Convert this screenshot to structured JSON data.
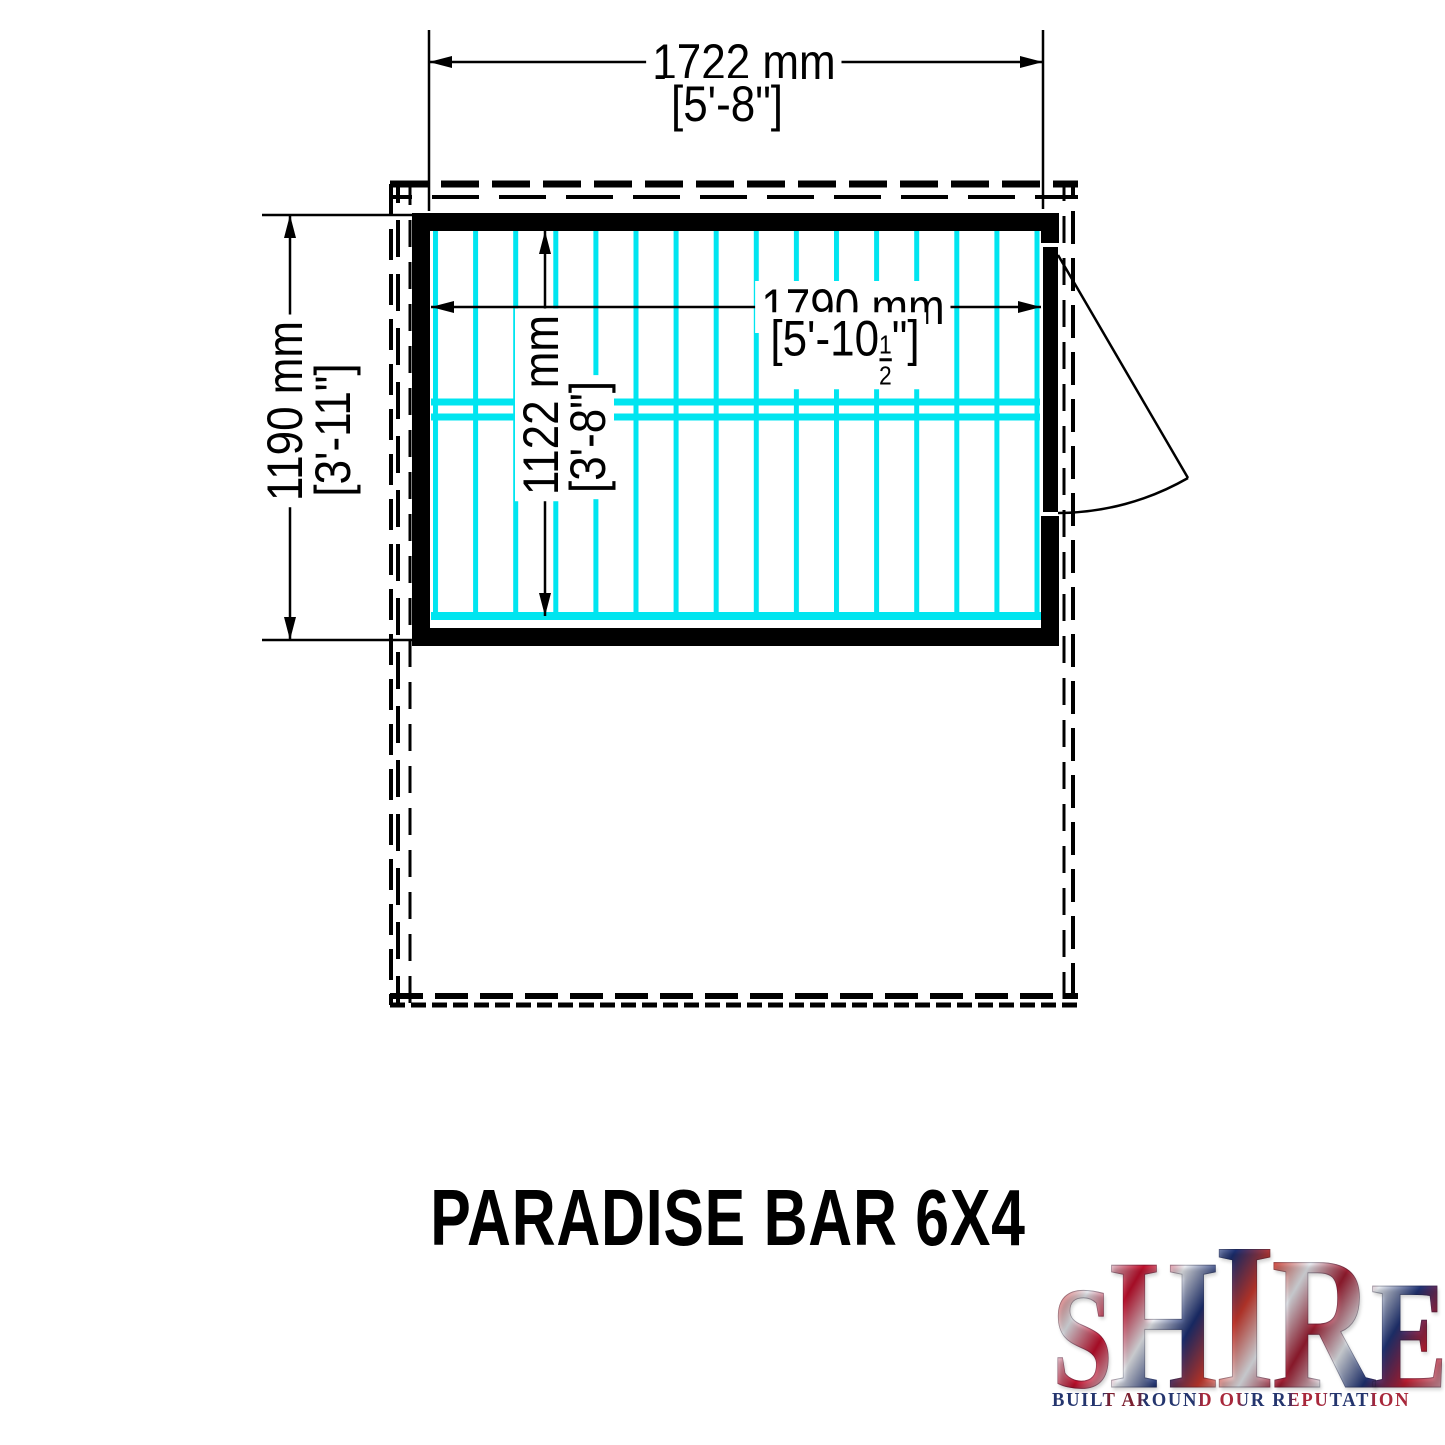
{
  "drawing": {
    "dimensions": {
      "external_width": {
        "metric": "1722 mm",
        "imperial": "[5'-8\"]"
      },
      "external_depth": {
        "metric": "1190 mm",
        "imperial": "[3'-11\"]"
      },
      "internal_width": {
        "metric": "1790 mm",
        "imperial_prefix": "[5'-10",
        "fraction_numerator": "1",
        "fraction_denominator": "2",
        "imperial_suffix": "\"]"
      },
      "internal_depth": {
        "metric": "1122 mm",
        "imperial": "[3'-8\"]"
      }
    }
  },
  "title": "PARADISE BAR 6X4",
  "logo": {
    "letters": [
      "S",
      "H",
      "I",
      "R",
      "E"
    ],
    "tagline": "BUILT AROUND OUR REPUTATION"
  },
  "colors": {
    "joists": "#00e5f0",
    "ink": "#000000",
    "logo_navy": "#24356e",
    "logo_red": "#c8102e"
  }
}
